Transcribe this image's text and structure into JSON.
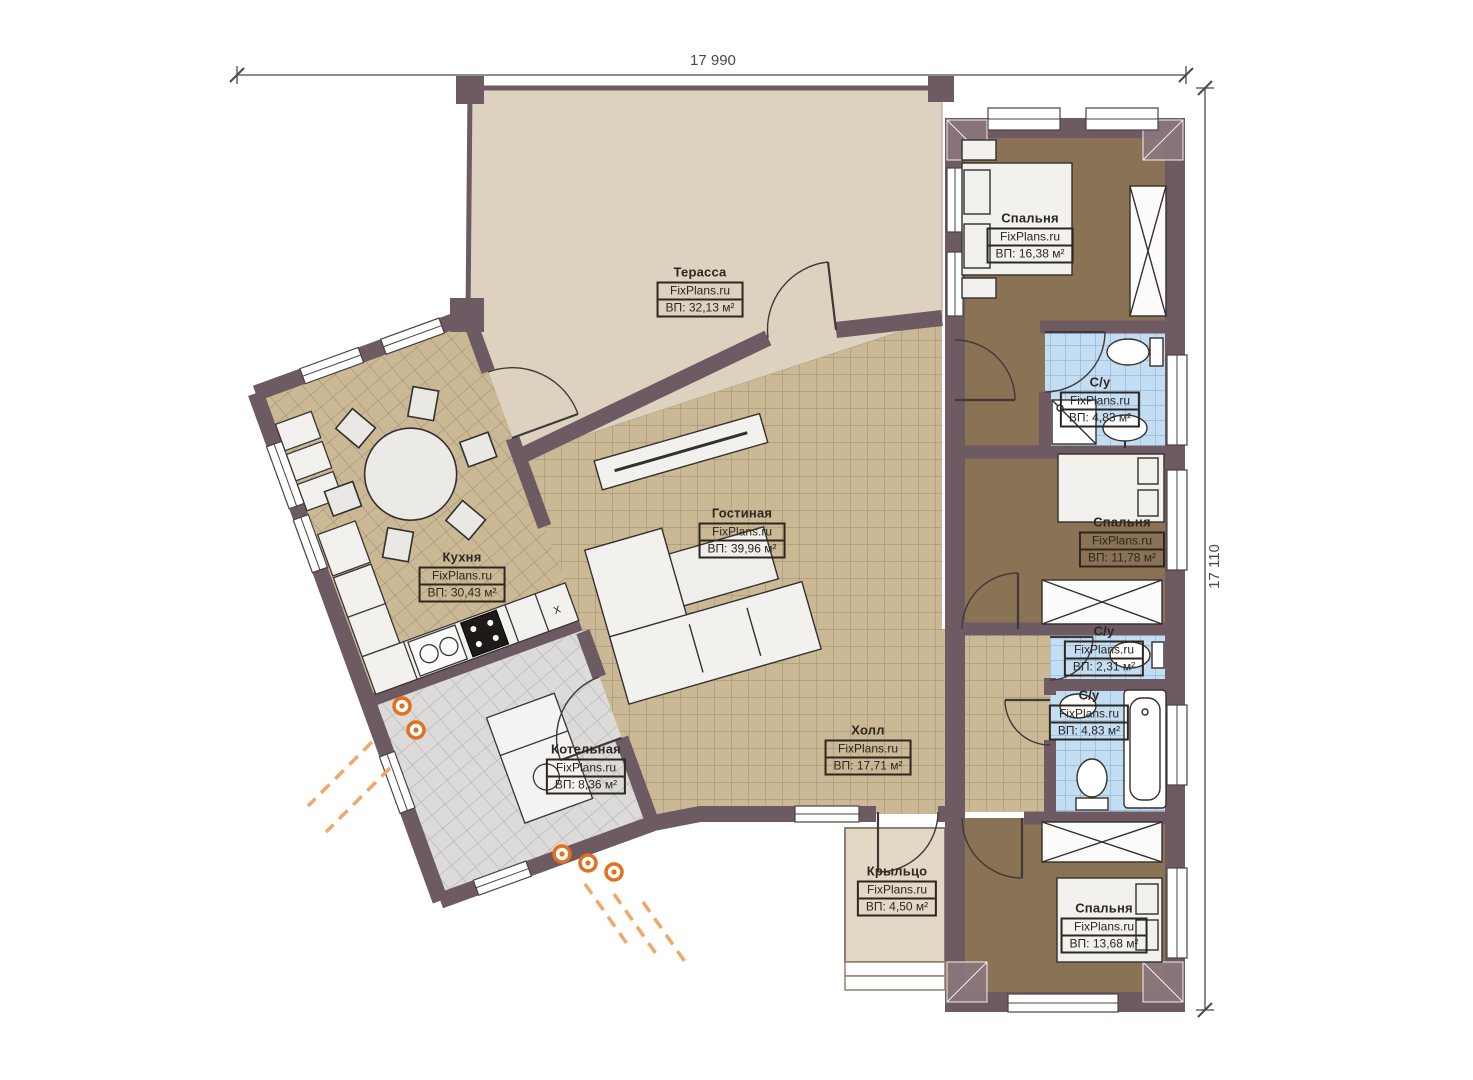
{
  "plan": {
    "brand": "FixPlans.ru",
    "dimensions": {
      "top": "17 990",
      "right": "17 110"
    },
    "rooms": [
      {
        "name": "Терасса",
        "brand": "FixPlans.ru",
        "area": "ВП: 32,13 м²"
      },
      {
        "name": "Спальня",
        "brand": "FixPlans.ru",
        "area": "ВП: 16,38 м²"
      },
      {
        "name": "С/у",
        "brand": "FixPlans.ru",
        "area": "ВП: 4,83 м²"
      },
      {
        "name": "Кухня",
        "brand": "FixPlans.ru",
        "area": "ВП: 30,43 м²"
      },
      {
        "name": "Гостиная",
        "brand": "FixPlans.ru",
        "area": "ВП: 39,96 м²"
      },
      {
        "name": "Спальня",
        "brand": "FixPlans.ru",
        "area": "ВП: 11,78 м²"
      },
      {
        "name": "С/у",
        "brand": "FixPlans.ru",
        "area": "ВП: 2,31 м²"
      },
      {
        "name": "С/у",
        "brand": "FixPlans.ru",
        "area": "ВП: 4,83 м²"
      },
      {
        "name": "Холл",
        "brand": "FixPlans.ru",
        "area": "ВП: 17,71 м²"
      },
      {
        "name": "Котельная",
        "brand": "FixPlans.ru",
        "area": "ВП: 8,36 м²"
      },
      {
        "name": "Крыльцо",
        "brand": "FixPlans.ru",
        "area": "ВП: 4,50 м²"
      },
      {
        "name": "Спальня",
        "brand": "FixPlans.ru",
        "area": "ВП: 13,68 м²"
      }
    ],
    "colors": {
      "wall": "#6e5a62",
      "terrace": "#ddd2c0",
      "tan_tile": "#cbb996",
      "carpet": "#8a7254",
      "blue_tile": "#c3ddf2",
      "gray_tile": "#dcdbd9",
      "utility_orange": "#e2701c"
    }
  }
}
